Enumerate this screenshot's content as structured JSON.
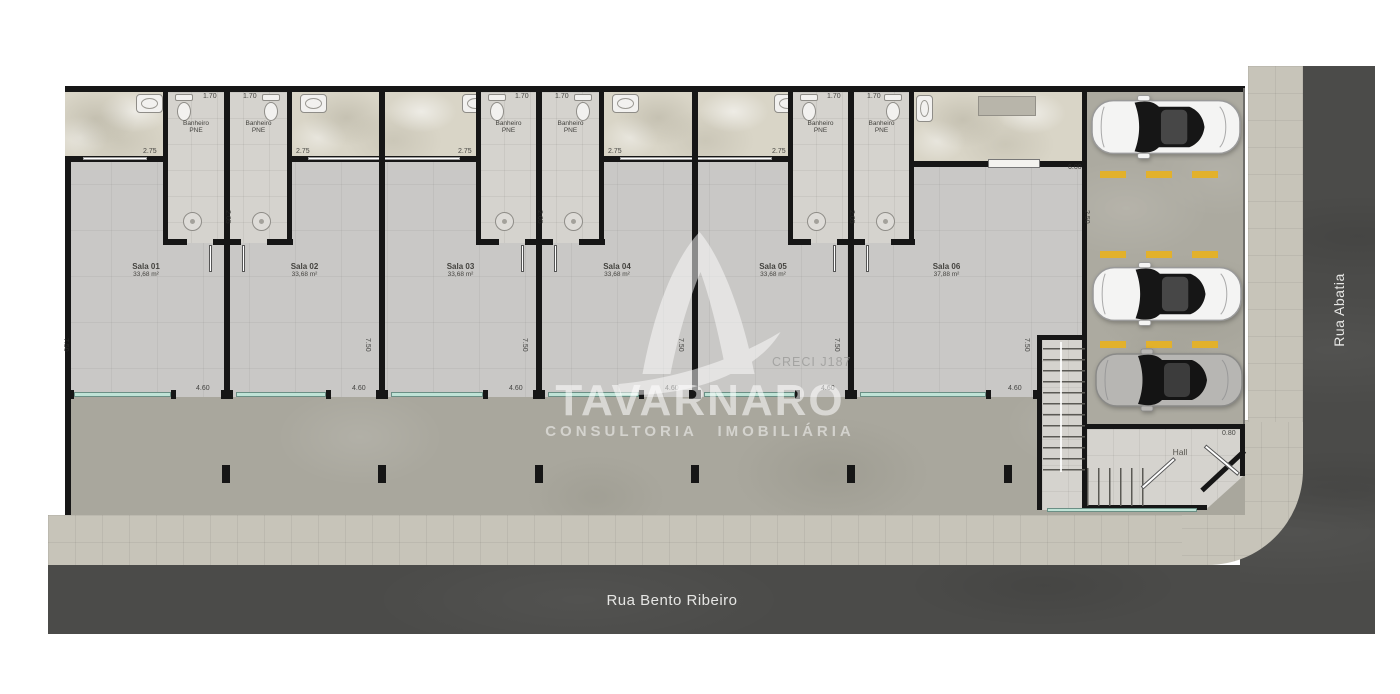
{
  "plan_title": "floor-plan",
  "watermark": {
    "brand": "TAVARNARO",
    "tagline": "CONSULTORIA IMOBILIÁRIA",
    "registration": "CRECI J187"
  },
  "streets": {
    "bottom_label": "Rua Bento Ribeiro",
    "right_label": "Rua Abatia"
  },
  "hall_label": "Hall",
  "bathroom_label": {
    "line1": "Banheiro",
    "line2": "PNE"
  },
  "rooms": [
    {
      "name": "Sala 01",
      "area": "33,68 m²"
    },
    {
      "name": "Sala 02",
      "area": "33,68 m²"
    },
    {
      "name": "Sala 03",
      "area": "33,68 m²"
    },
    {
      "name": "Sala 04",
      "area": "33,68 m²"
    },
    {
      "name": "Sala 05",
      "area": "33,68 m²"
    },
    {
      "name": "Sala 06",
      "area": "37,88 m²"
    }
  ],
  "parking": {
    "stalls": 3,
    "cars": [
      "white-car",
      "white-car",
      "silver-car"
    ]
  },
  "dimension_labels": [
    {
      "text": "1.70",
      "x": 203,
      "y": 93,
      "rot": 0
    },
    {
      "text": "1.70",
      "x": 243,
      "y": 93,
      "rot": 0
    },
    {
      "text": "1.70",
      "x": 515,
      "y": 93,
      "rot": 0
    },
    {
      "text": "1.70",
      "x": 555,
      "y": 93,
      "rot": 0
    },
    {
      "text": "1.70",
      "x": 827,
      "y": 93,
      "rot": 0
    },
    {
      "text": "1.70",
      "x": 867,
      "y": 93,
      "rot": 0
    },
    {
      "text": "2.75",
      "x": 143,
      "y": 148,
      "rot": 0
    },
    {
      "text": "2.75",
      "x": 296,
      "y": 148,
      "rot": 0
    },
    {
      "text": "2.75",
      "x": 458,
      "y": 148,
      "rot": 0
    },
    {
      "text": "2.75",
      "x": 608,
      "y": 148,
      "rot": 0
    },
    {
      "text": "2.75",
      "x": 772,
      "y": 148,
      "rot": 0
    },
    {
      "text": "2.05",
      "x": 231,
      "y": 210,
      "rot": 90
    },
    {
      "text": "2.05",
      "x": 543,
      "y": 210,
      "rot": 90
    },
    {
      "text": "2.05",
      "x": 855,
      "y": 210,
      "rot": 90
    },
    {
      "text": "7.50",
      "x": 69,
      "y": 338,
      "rot": 90
    },
    {
      "text": "7.50",
      "x": 371,
      "y": 338,
      "rot": 90
    },
    {
      "text": "7.50",
      "x": 528,
      "y": 338,
      "rot": 90
    },
    {
      "text": "7.50",
      "x": 684,
      "y": 338,
      "rot": 90
    },
    {
      "text": "7.50",
      "x": 840,
      "y": 338,
      "rot": 90
    },
    {
      "text": "7.50",
      "x": 1030,
      "y": 338,
      "rot": 90
    },
    {
      "text": "4.60",
      "x": 196,
      "y": 385,
      "rot": 0
    },
    {
      "text": "4.60",
      "x": 352,
      "y": 385,
      "rot": 0
    },
    {
      "text": "4.60",
      "x": 509,
      "y": 385,
      "rot": 0
    },
    {
      "text": "4.60",
      "x": 665,
      "y": 385,
      "rot": 0
    },
    {
      "text": "4.60",
      "x": 821,
      "y": 385,
      "rot": 0
    },
    {
      "text": "4.60",
      "x": 1008,
      "y": 385,
      "rot": 0
    },
    {
      "text": "6.00",
      "x": 1068,
      "y": 164,
      "rot": 0
    },
    {
      "text": "2.50",
      "x": 1090,
      "y": 210,
      "rot": 90
    },
    {
      "text": "0.80",
      "x": 1222,
      "y": 430,
      "rot": 0
    }
  ],
  "colors": {
    "wall": "#161616",
    "room_floor": "#c9c8c6",
    "patio": "#d9d5c7",
    "concrete_yard": "#a9a79d",
    "sidewalk": "#c7c4b9",
    "street": "#4b4b49",
    "glass_front": "#bfe3d6",
    "parking_marking": "#e2b12c",
    "watermark_text": "#ffffff"
  }
}
